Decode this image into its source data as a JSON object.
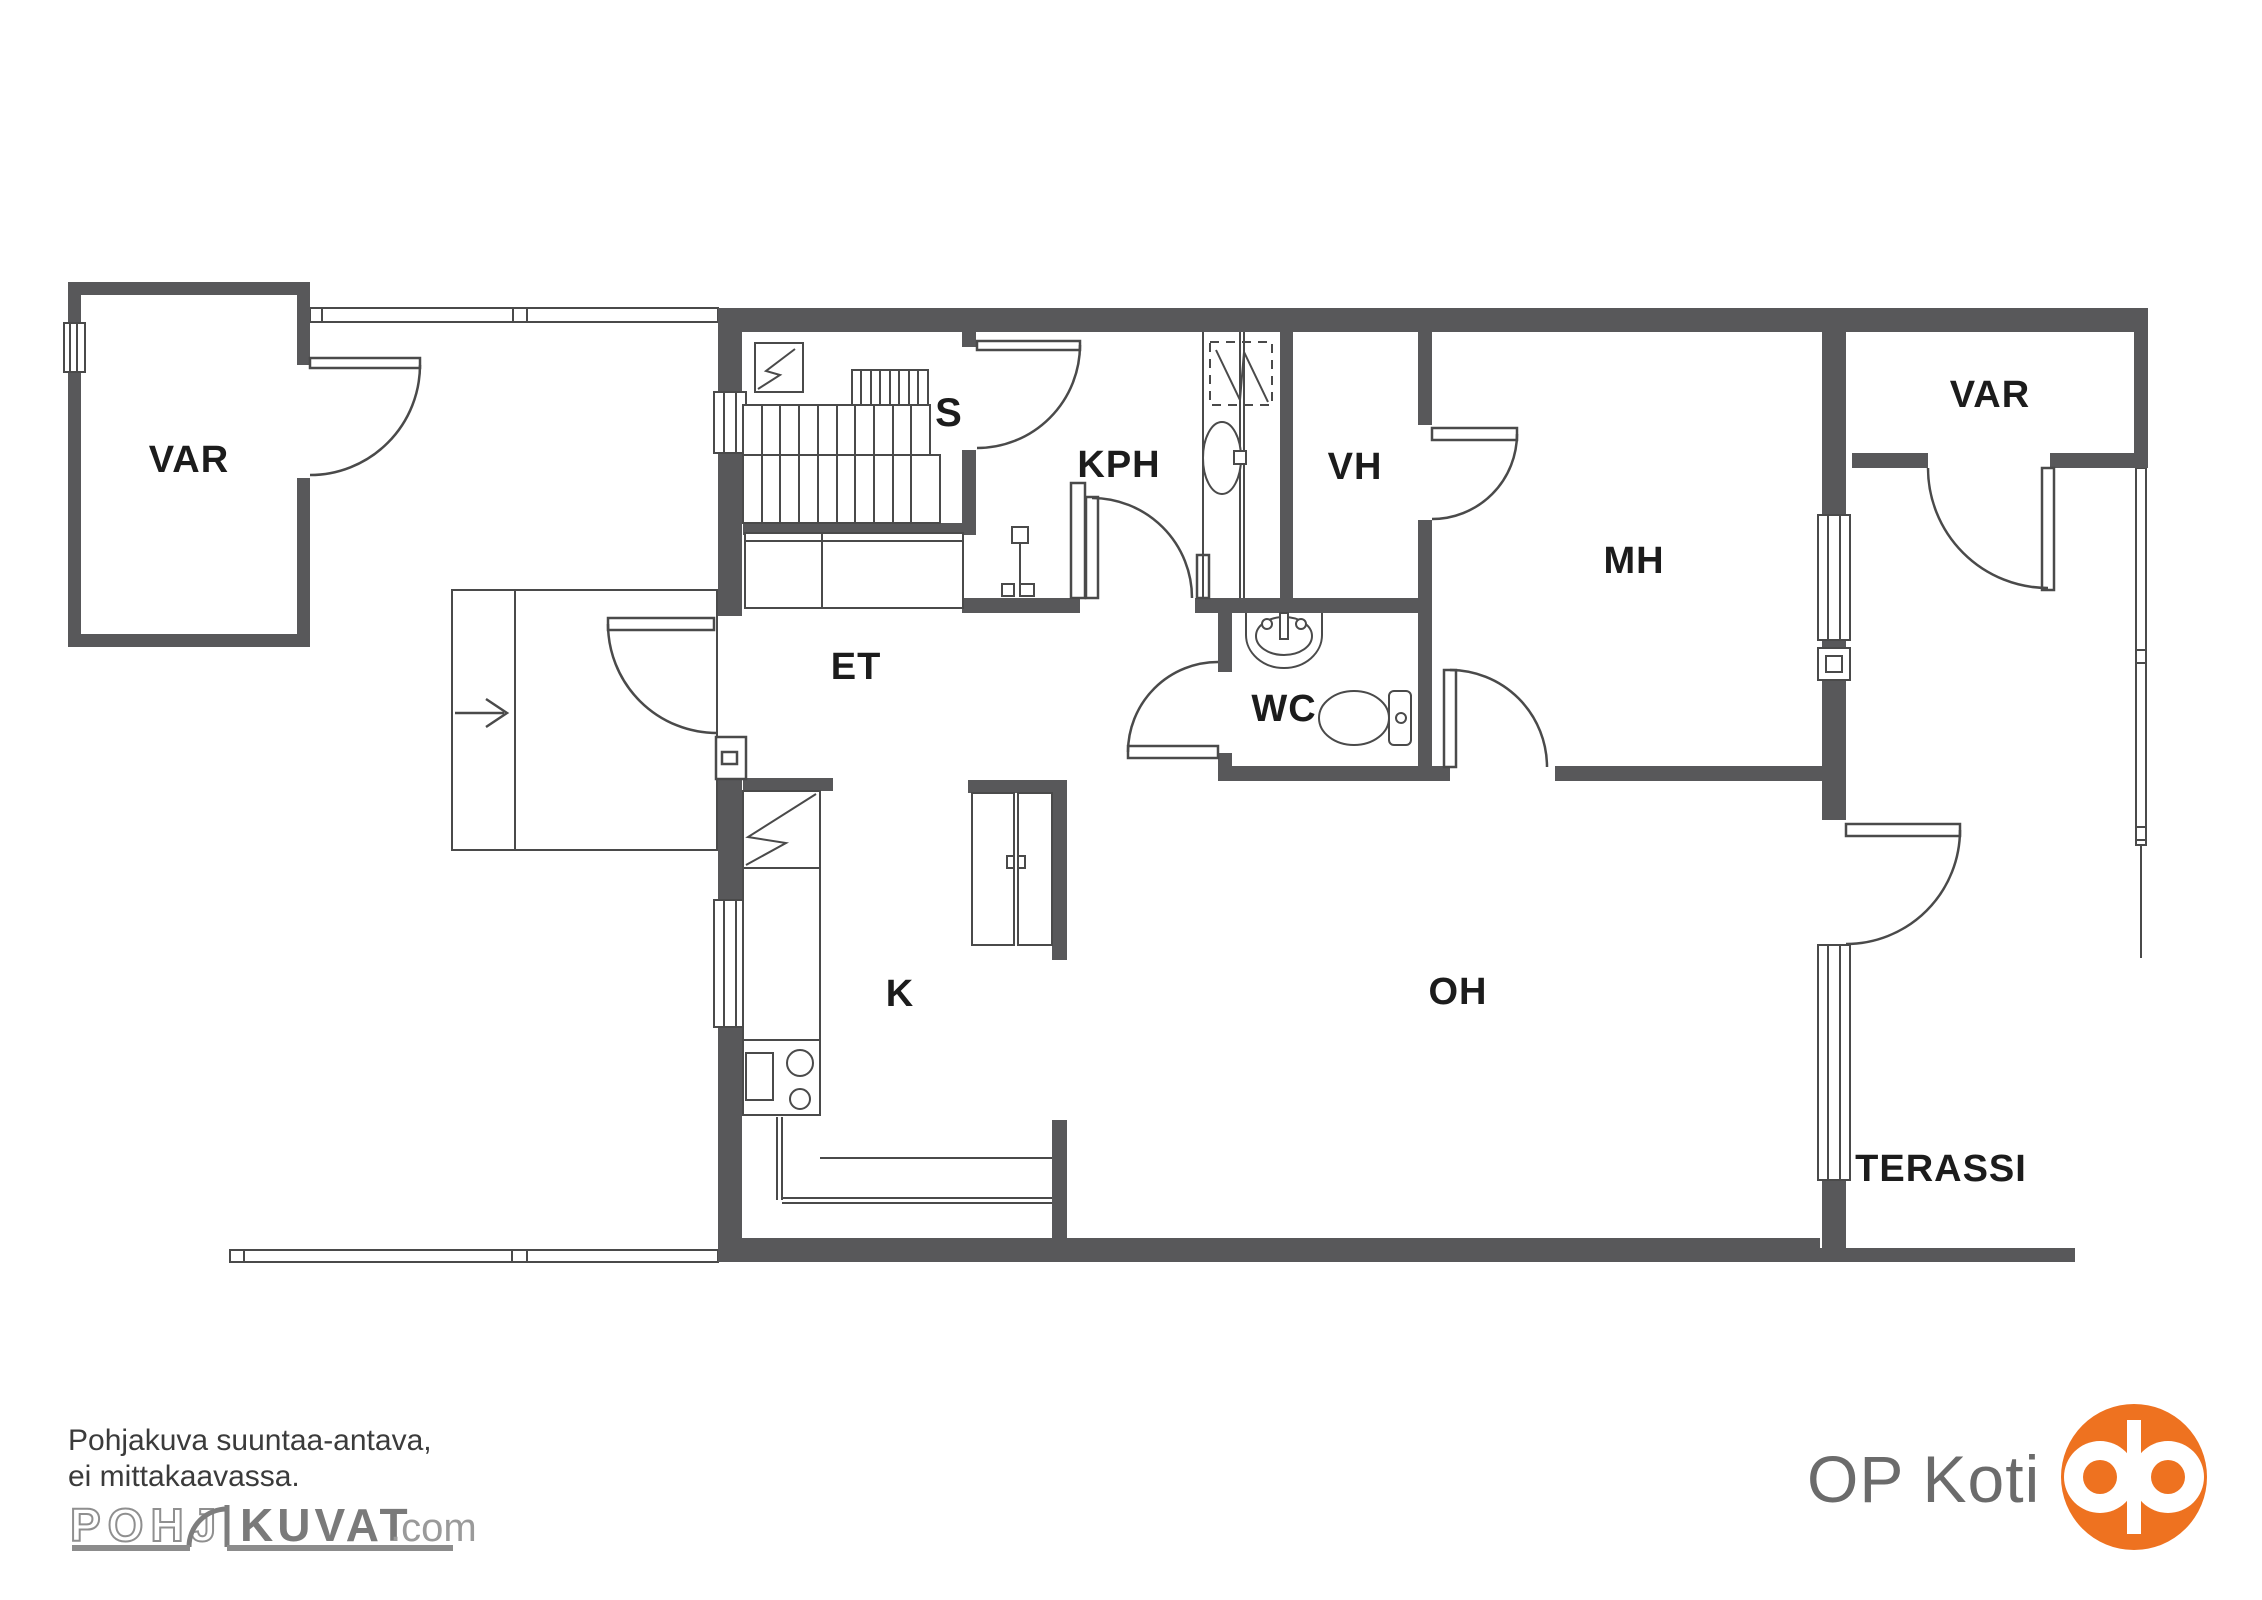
{
  "page": {
    "background": "#FFFFFF"
  },
  "floorplan": {
    "rooms": [
      {
        "id": "var_left",
        "label": "VAR"
      },
      {
        "id": "s",
        "label": "S"
      },
      {
        "id": "kph",
        "label": "KPH"
      },
      {
        "id": "vh",
        "label": "VH"
      },
      {
        "id": "mh",
        "label": "MH"
      },
      {
        "id": "var_right",
        "label": "VAR"
      },
      {
        "id": "et",
        "label": "ET"
      },
      {
        "id": "wc",
        "label": "WC"
      },
      {
        "id": "k",
        "label": "K"
      },
      {
        "id": "oh",
        "label": "OH"
      },
      {
        "id": "terassi",
        "label": "TERASSI"
      }
    ],
    "icons": [
      "sauna-stove-icon",
      "stairs-icon",
      "shower-icon",
      "washbasin-icon",
      "wc-sink-icon",
      "toilet-icon",
      "fridge-icon",
      "stove-icon",
      "entrance-arrow-icon",
      "door-swing-icon",
      "window-icon"
    ],
    "colors": {
      "wall": "#58585A",
      "line": "#4A4A4A",
      "label": "#1C1C1C"
    }
  },
  "footer": {
    "disclaimer_line1": "Pohjakuva suuntaa-antava,",
    "disclaimer_line2": "ei mittakaavassa."
  },
  "branding": {
    "pohjakuvat": {
      "word_outline": "POHJ",
      "word_solid": "KUVAT",
      "suffix": ".com",
      "outline_color": "#8F8F8F",
      "solid_color": "#7A7A7A",
      "suffix_color": "#9A9A9A",
      "bar_color": "#8C8C8C"
    },
    "op": {
      "text": "OP Koti",
      "text_color": "#6B6B6B",
      "logo_color": "#EE7220"
    }
  }
}
